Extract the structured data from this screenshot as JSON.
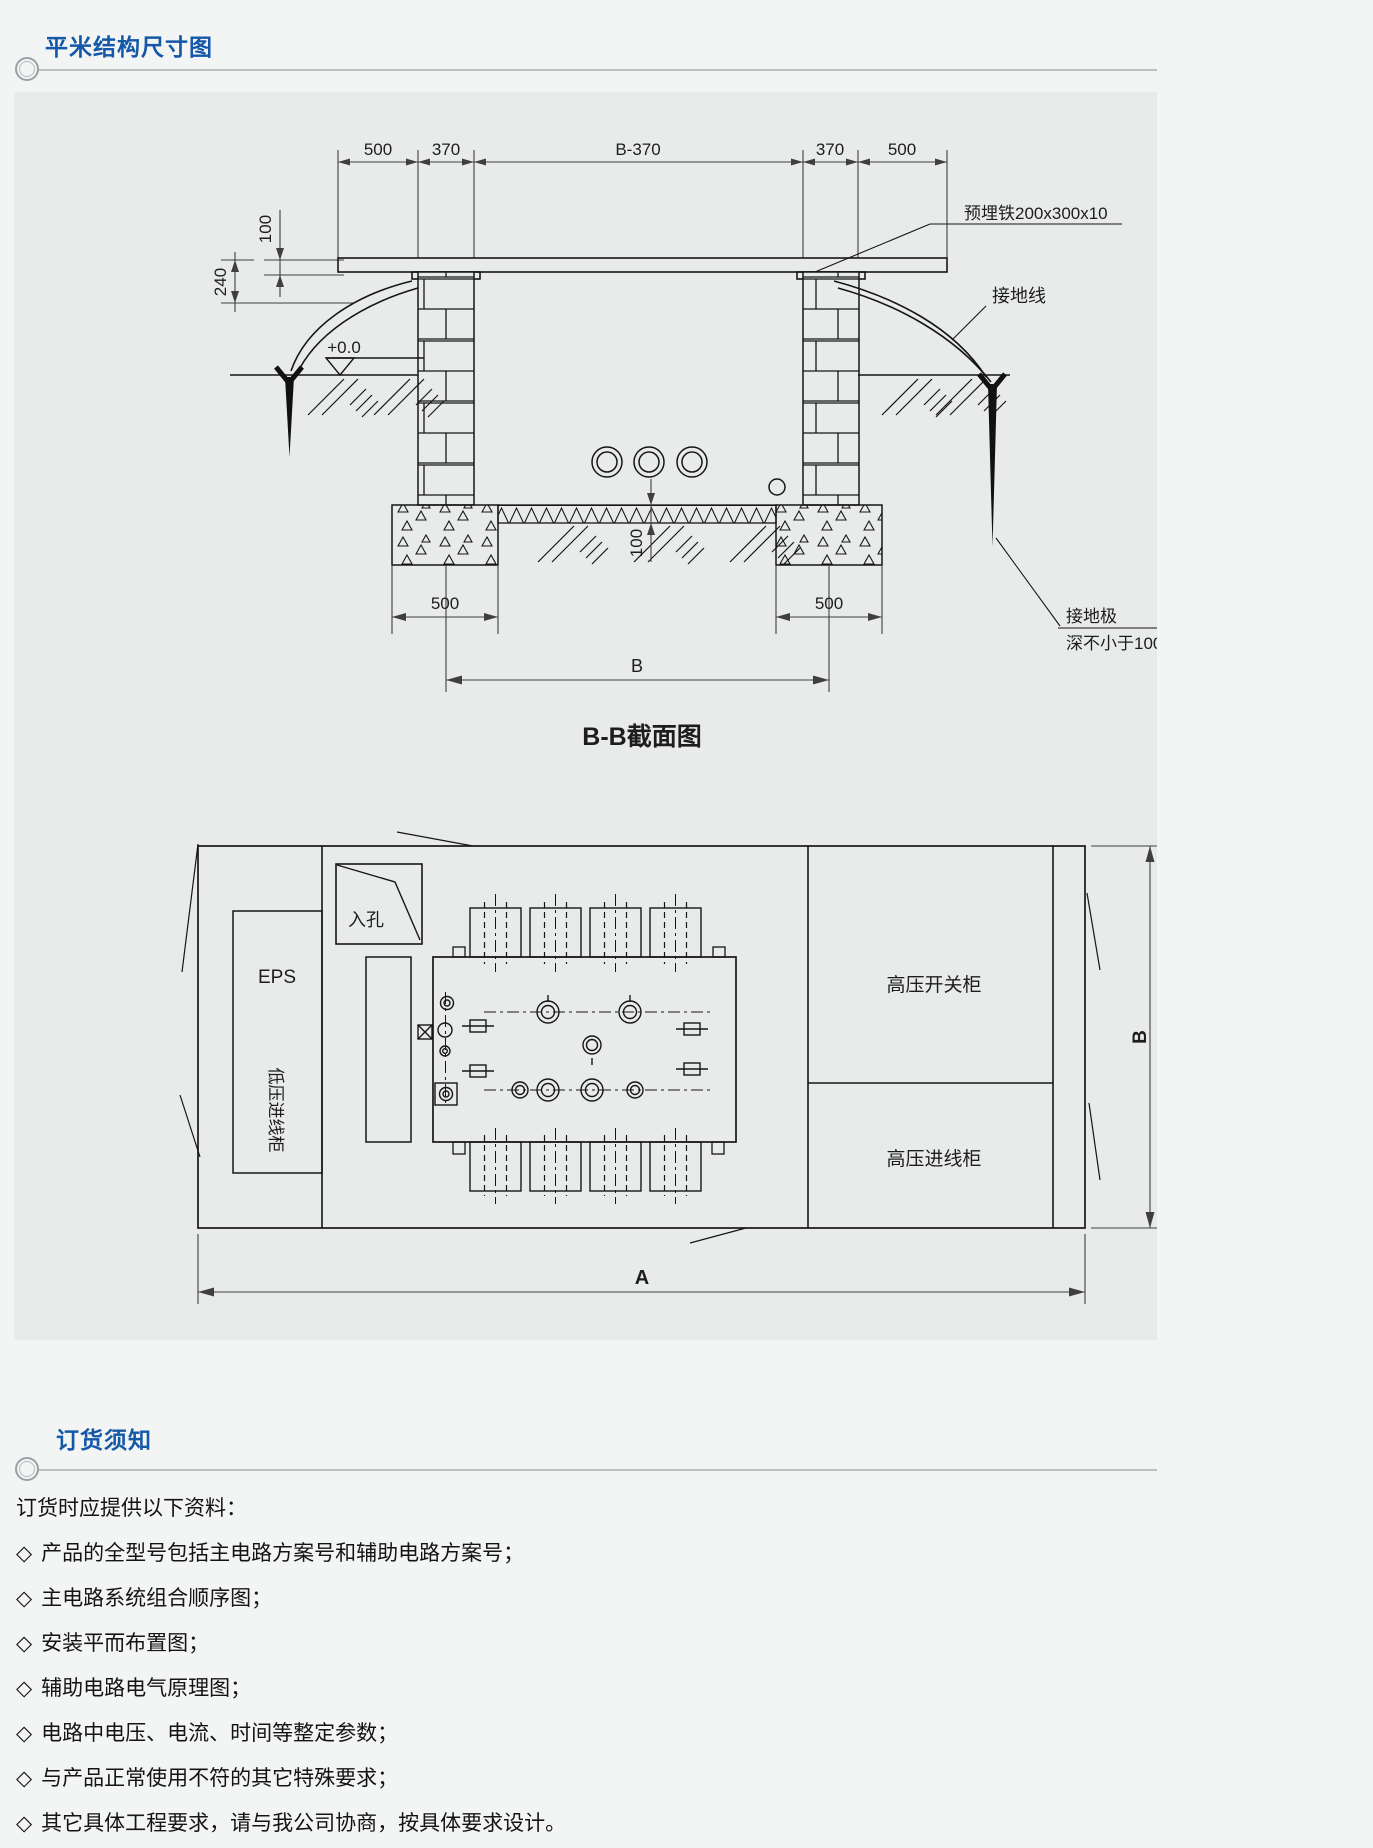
{
  "page": {
    "accent": "#1558a8",
    "panel_bg": "#e9ebeb"
  },
  "sections": {
    "structure_title": "平米结构尺寸图",
    "ordering_title": "订货须知"
  },
  "cross_section": {
    "caption": "B-B截面图",
    "dims_top": [
      "500",
      "370",
      "B-370",
      "370",
      "500"
    ],
    "dim_left_upper": "100",
    "dim_left_lower": "240",
    "level_mark": "+0.0",
    "dim_floor": "100",
    "dim_foundation_left": "500",
    "dim_foundation_right": "500",
    "dim_span": "B",
    "label_embedded_plate": "预埋铁200x300x10",
    "label_ground_wire": "接地线",
    "label_ground_rod": "接地极",
    "label_ground_rod_depth": "深不小于1000"
  },
  "plan": {
    "label_manhole": "入孔",
    "label_eps": "EPS",
    "label_lv_incoming": "低压进线柜",
    "label_hv_switchgear": "高压开关柜",
    "label_hv_incoming": "高压进线柜",
    "dim_width": "A",
    "dim_depth": "B"
  },
  "notes": {
    "bullet": "◇",
    "intro": "订货时应提供以下资料：",
    "items": [
      "产品的全型号包括主电路方案号和辅助电路方案号；",
      "主电路系统组合顺序图；",
      "安装平而布置图；",
      "辅助电路电气原理图；",
      "电路中电压、电流、时间等整定参数；",
      "与产品正常使用不符的其它特殊要求；",
      "其它具体工程要求，请与我公司协商，按具体要求设计。"
    ]
  }
}
